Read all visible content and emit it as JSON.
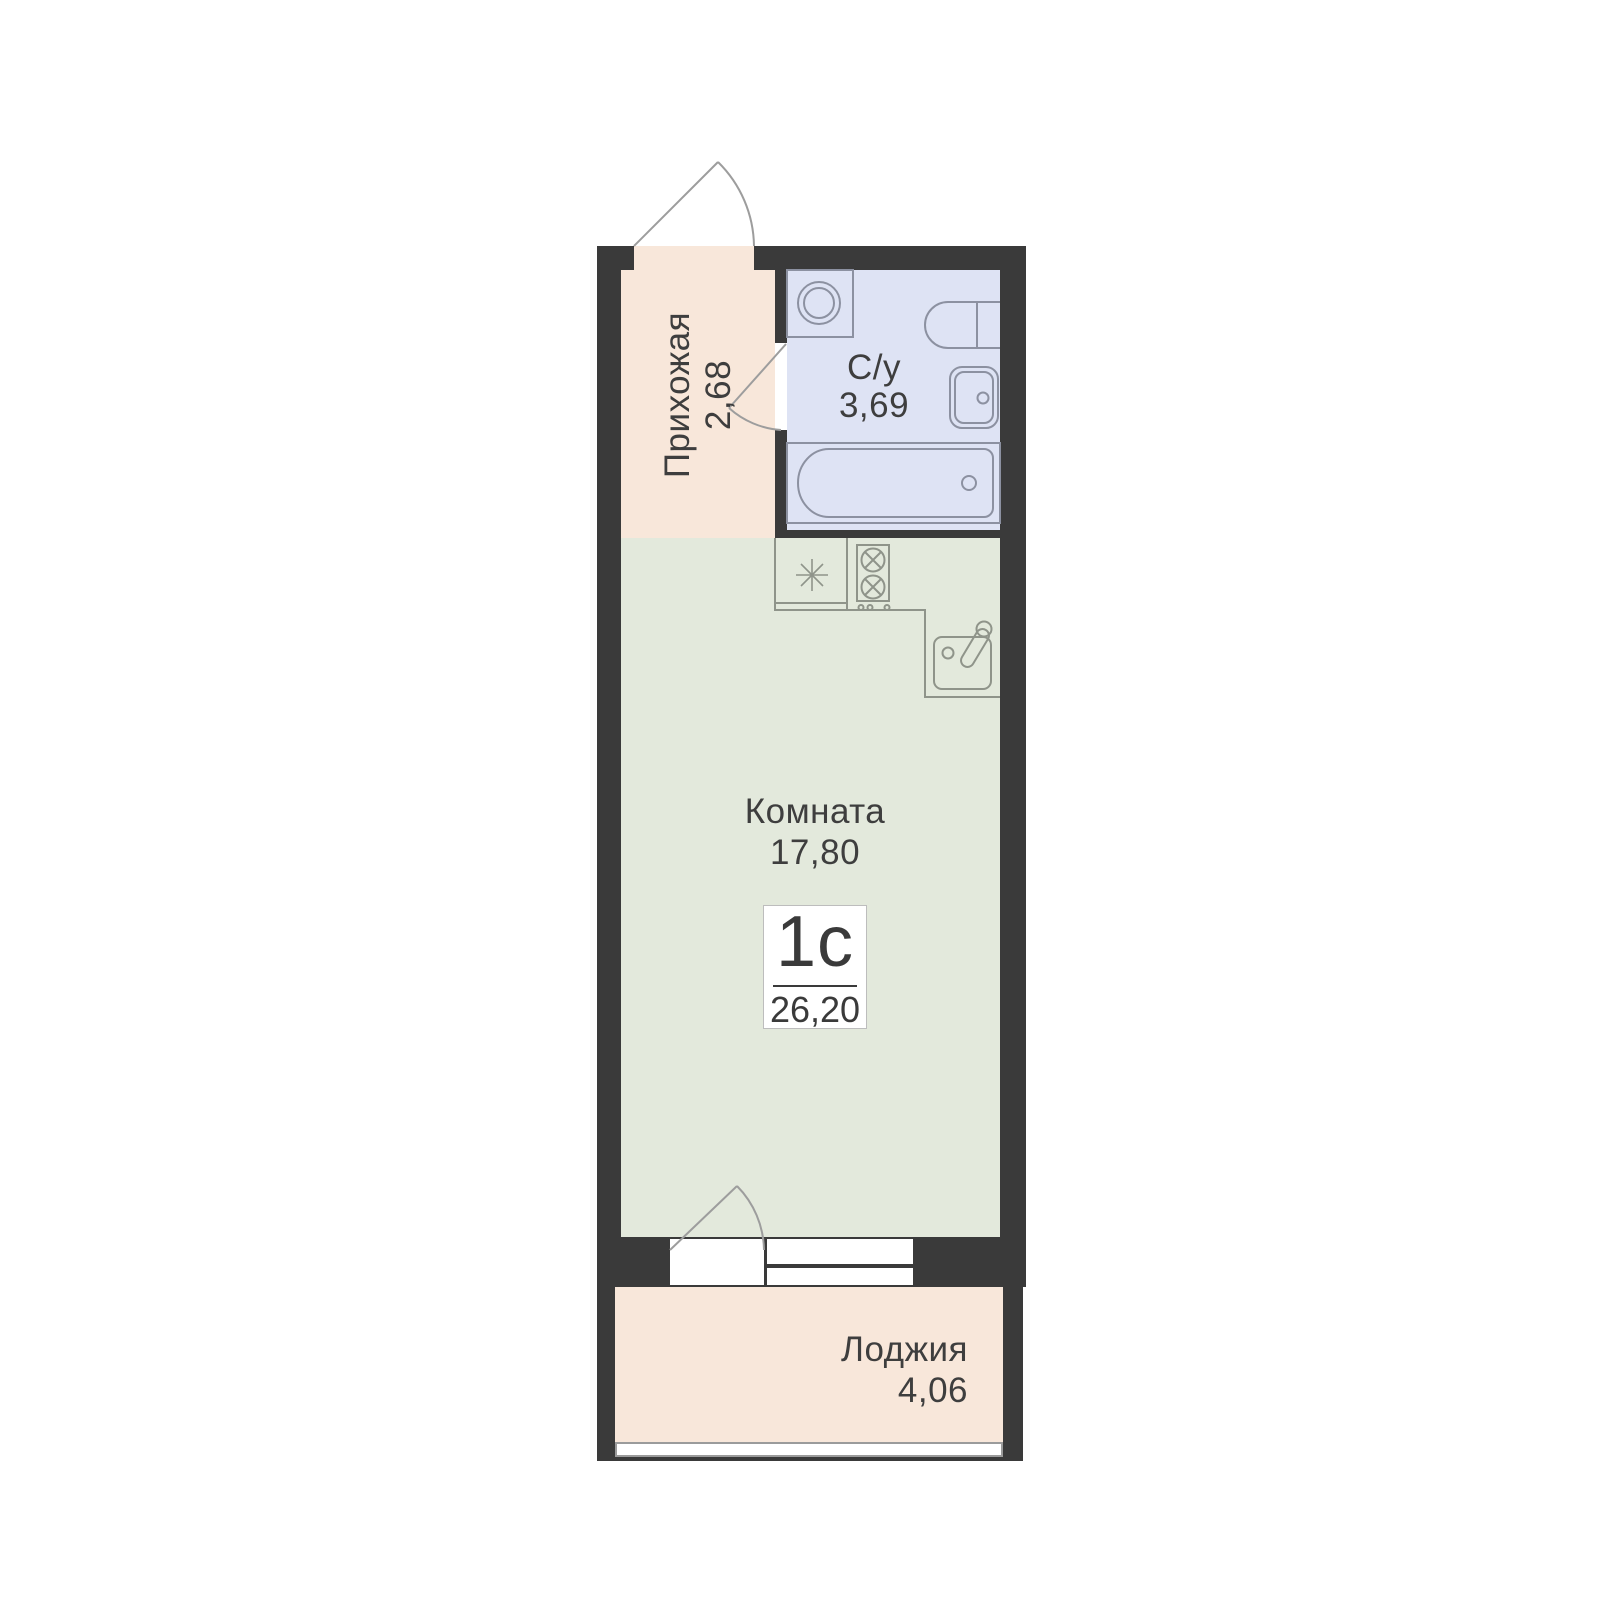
{
  "plan": {
    "badge": {
      "type_label": "1с",
      "total_area": "26,20"
    },
    "rooms": [
      {
        "id": "hallway",
        "name": "Прихожая",
        "area": "2,68"
      },
      {
        "id": "bathroom",
        "name": "С/у",
        "area": "3,69"
      },
      {
        "id": "room",
        "name": "Комната",
        "area": "17,80"
      },
      {
        "id": "loggia",
        "name": "Лоджия",
        "area": "4,06"
      }
    ],
    "colors": {
      "wall": "#3a3a3a",
      "hallway_fill": "#f8e7da",
      "bathroom_fill": "#dee3f4",
      "room_fill": "#e3e9dc",
      "loggia_fill": "#f8e7da",
      "text": "#3e3e3e",
      "bathroom_fixture_stroke": "#8c91a1",
      "kitchen_fixture_stroke": "#8f948a",
      "door_stroke": "#9d9d9d",
      "badge_border": "#bdbdbd"
    }
  }
}
